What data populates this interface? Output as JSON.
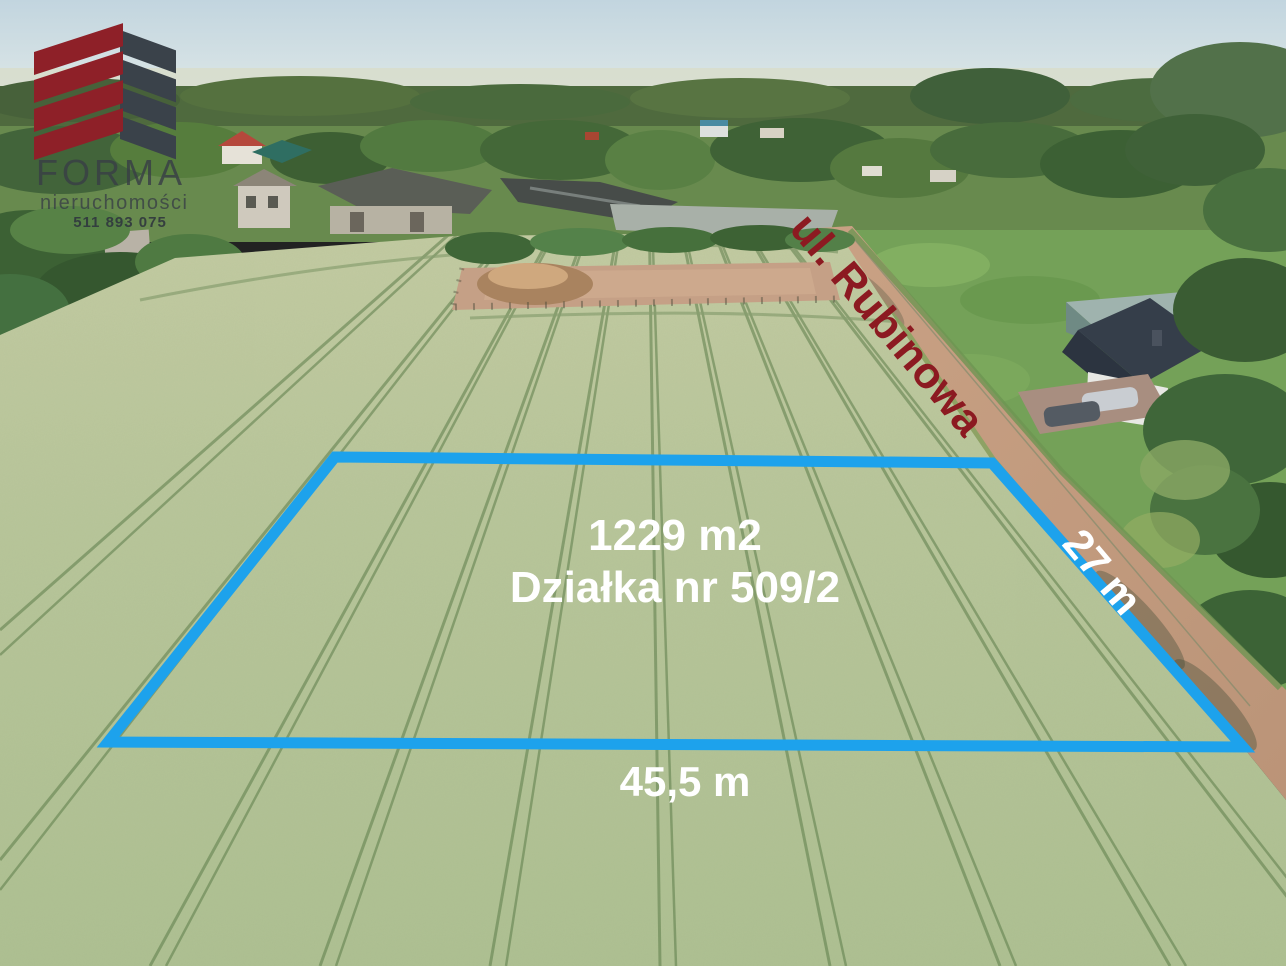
{
  "logo": {
    "company": "FORMA",
    "tagline": "nieruchomości",
    "phone": "511 893 075"
  },
  "labels": {
    "street": "ul. Rubinowa",
    "area": "1229 m2",
    "parcel": "Działka nr 509/2",
    "width": "45,5 m",
    "depth": "27 m"
  },
  "colors": {
    "outline": "#1da2ec",
    "street_text": "#8c1a21",
    "dimension_text": "#ffffff",
    "logo_red": "#8e2028",
    "logo_charcoal": "#3a424a"
  },
  "outline_points": "335,457 992,463 1243,747 108,742"
}
